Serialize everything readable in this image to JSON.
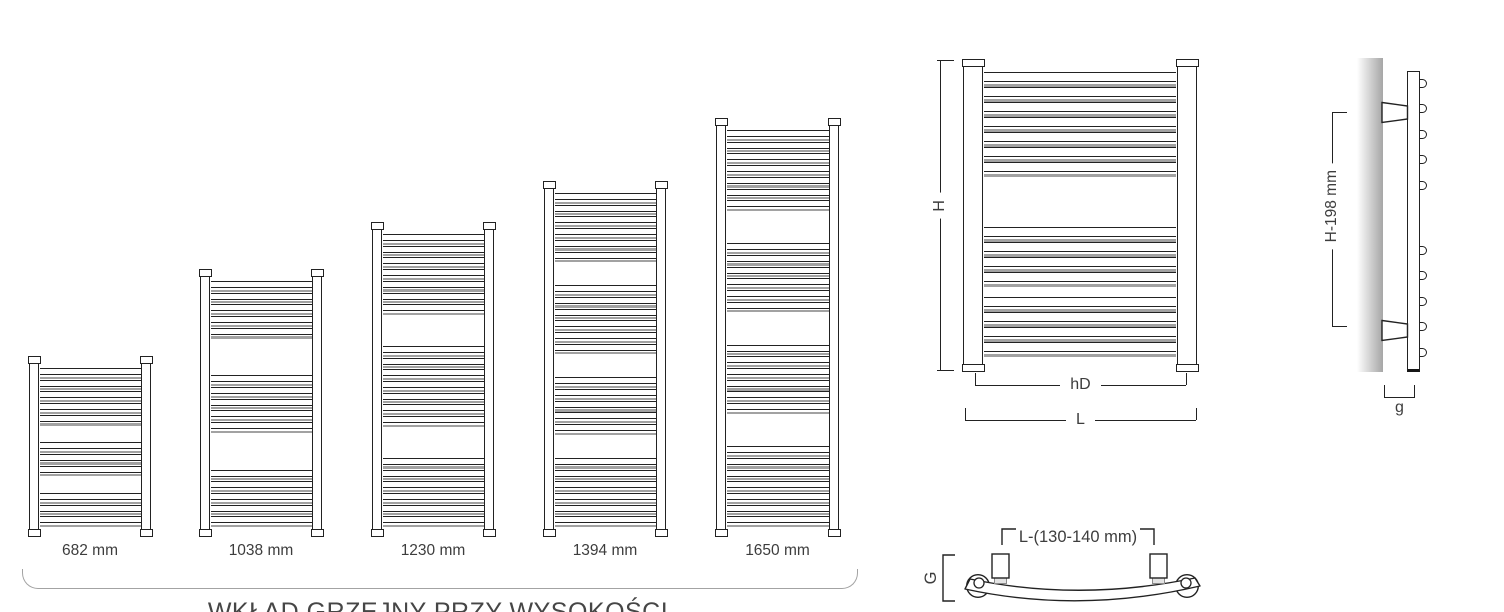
{
  "sheet": {
    "title": "towel radiator dimension diagram"
  },
  "colors": {
    "line": "#222222",
    "gray_line": "#a2a2a2",
    "text": "#3d3d3d",
    "brace": "#a3a3a3",
    "wall": "#a6a6a6"
  },
  "radiators": [
    {
      "label": "682 mm",
      "height_px": 181,
      "x": 29,
      "width": 122,
      "groups": [
        5,
        3,
        3
      ]
    },
    {
      "label": "1038 mm",
      "height_px": 268,
      "x": 200,
      "width": 122,
      "groups": [
        5,
        5,
        5
      ]
    },
    {
      "label": "1230 mm",
      "height_px": 315,
      "x": 372,
      "width": 122,
      "groups": [
        7,
        7,
        6
      ]
    },
    {
      "label": "1394 mm",
      "height_px": 356,
      "x": 544,
      "width": 122,
      "groups": [
        6,
        6,
        5,
        6
      ]
    },
    {
      "label": "1650 mm",
      "height_px": 419,
      "x": 716,
      "width": 123,
      "groups": [
        7,
        6,
        6,
        7
      ]
    }
  ],
  "caption": {
    "text": "WKŁAD GRZEJNY PRZY WYSOKOŚCI"
  },
  "front_view": {
    "dim_h": "H",
    "dim_hd": "hD",
    "dim_l": "L",
    "groups": [
      7,
      4,
      4
    ]
  },
  "side_view": {
    "dim_height": "H-198 mm",
    "dim_depth": "g",
    "bump_groups": [
      5,
      5
    ]
  },
  "top_view": {
    "dim_spacing": "L-(130-140 mm)",
    "dim_g": "G"
  }
}
